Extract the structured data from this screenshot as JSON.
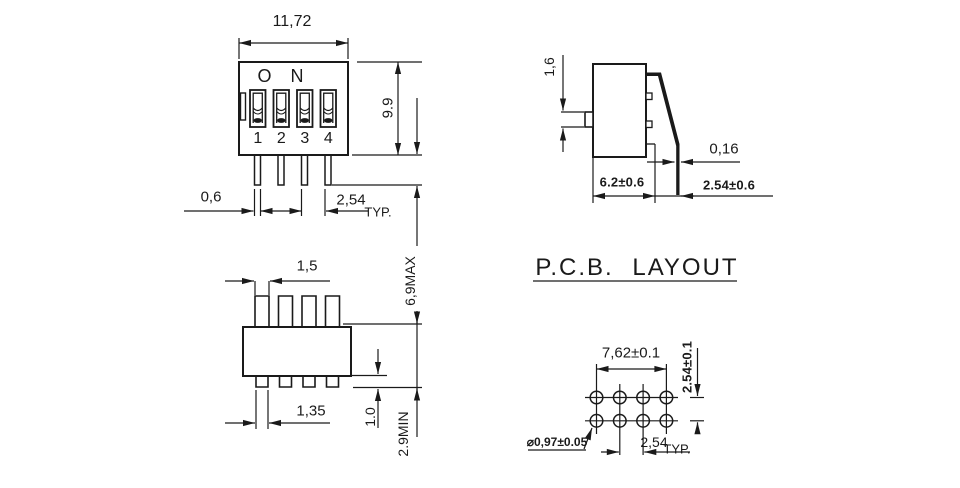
{
  "front_view": {
    "width_dim": "11,72",
    "height_dim": "9.9",
    "on_label": "O N",
    "switch_labels": [
      "1",
      "2",
      "3",
      "4"
    ],
    "pin_width_dim": "0,6",
    "pitch_dim": "2,54",
    "pitch_qualifier": "TYP."
  },
  "side_view": {
    "actuator_height_dim": "1,6",
    "pin_thickness_dim": "0,16",
    "body_depth_dim": "6.2±0.6",
    "pin_offset_dim": "2.54±0.6"
  },
  "bottom_view": {
    "upper_tab_width_dim": "1,5",
    "overall_height_dim": "6,9MAX",
    "lower_tab_width_dim": "1,35",
    "lower_tab_height_dim": "1.0",
    "pin_length_dim": "2.9MIN"
  },
  "pcb_layout": {
    "title": "P.C.B.  LAYOUT",
    "row_span_dim": "7,62±0.1",
    "row_pitch_dim": "2.54±0.1",
    "hole_diameter_dim": "⌀0,97±0.05",
    "col_pitch_dim": "2,54",
    "col_pitch_qualifier": "TYP."
  },
  "colors": {
    "line": "#1a1a1a",
    "background": "#ffffff"
  }
}
